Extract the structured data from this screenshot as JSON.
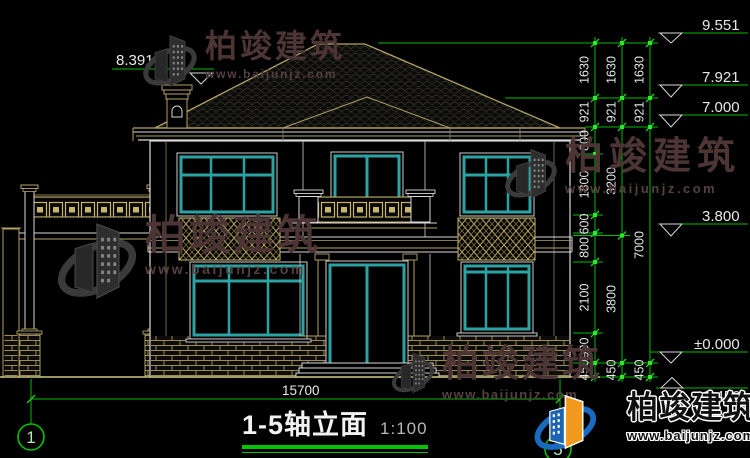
{
  "drawing": {
    "title": "1-5轴立面",
    "scale": "1:100",
    "bottom_dim": "15700",
    "chimney_level": "8.391",
    "axis_left": "1",
    "axis_right": "5",
    "levels": {
      "roof_top": "9.551",
      "eave_top": "7.921",
      "eave_bottom": "7.000",
      "second_floor": "3.800",
      "zero": "±0.000",
      "outdoor_ground": "-0.450"
    },
    "chain1": [
      "1630",
      "921",
      "800",
      "1800",
      "600",
      "800",
      "2100",
      "900",
      "450"
    ],
    "chain2": [
      "1630",
      "921",
      "3200",
      "3800",
      "450"
    ],
    "chain3": [
      "1630",
      "921",
      "7000",
      "450"
    ]
  },
  "watermark": {
    "brand": "柏竣建筑",
    "url": "www.baijunjz.com"
  },
  "colors": {
    "dim_green": "#00bb00",
    "cad_tan": "#b3a266",
    "window_teal": "#2ba3a3",
    "ground_olive": "#c9c97e"
  }
}
